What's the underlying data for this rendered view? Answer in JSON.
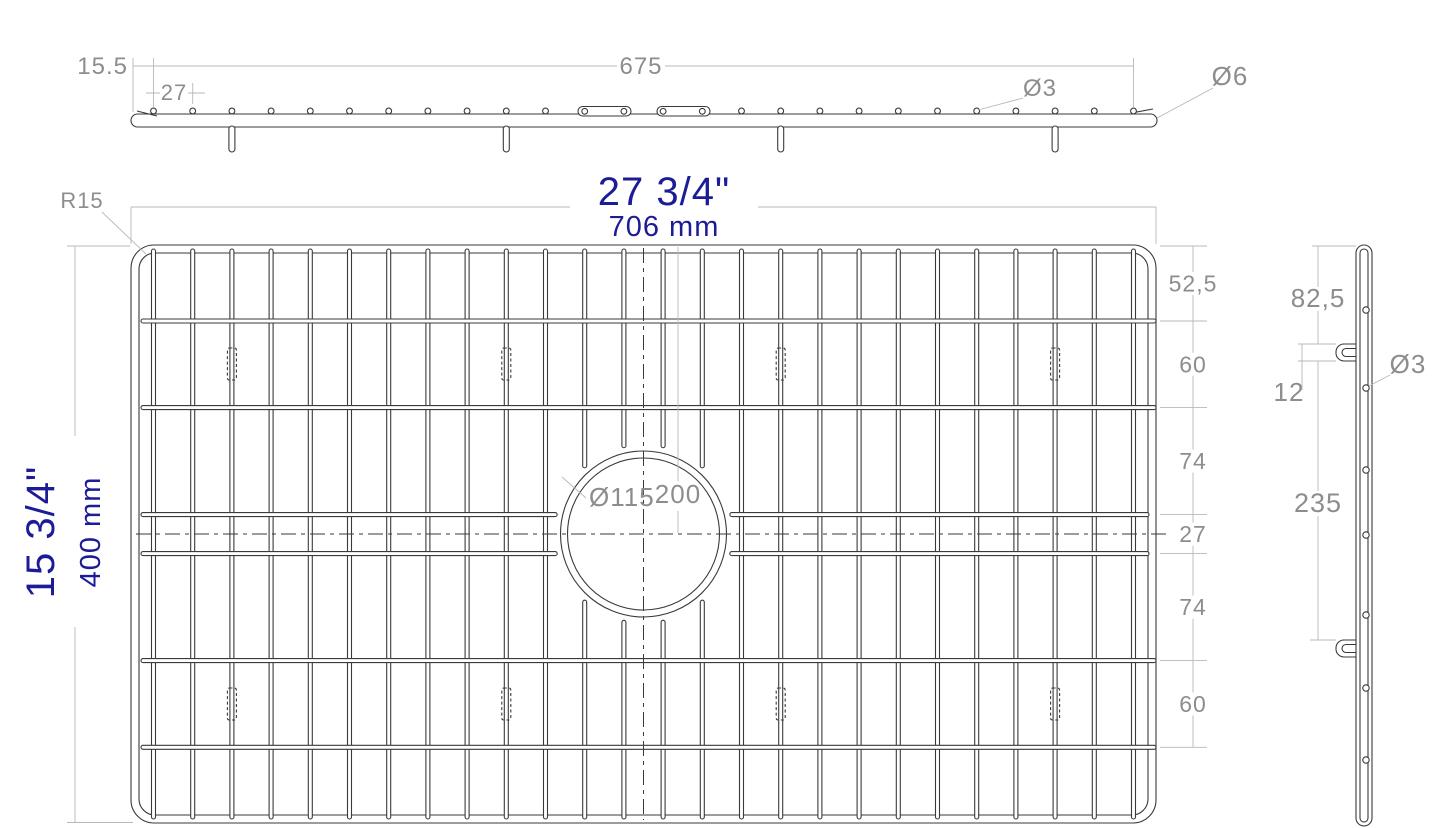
{
  "drawing_title": "sink grid technical drawing",
  "colors": {
    "object_line": "#3a3a3a",
    "dim_line": "#b8b8b8",
    "dim_text": "#8d8d8d",
    "accent_text": "#1c1c96",
    "background": "#ffffff"
  },
  "top_view": {
    "edge_offset": "15.5",
    "wire_pitch": "27",
    "span": "675",
    "wire_dia": "Ø3",
    "frame_dia": "Ø6"
  },
  "front_view": {
    "width_in": "27 3/4\"",
    "width_mm": "706 mm",
    "height_in": "15 3/4\"",
    "height_mm": "400 mm",
    "corner_radius": "R15",
    "center_hole_dia": "Ø115",
    "center_offset": "200",
    "right_chain": [
      "52,5",
      "60",
      "74",
      "27",
      "74",
      "60"
    ]
  },
  "side_view": {
    "top_offset": "82,5",
    "foot_length": "12",
    "feet_spacing": "235",
    "wire_dia": "Ø3"
  },
  "geometry": {
    "frame": {
      "x": 131,
      "y": 245,
      "w": 1025,
      "h": 578,
      "rx": 23
    },
    "wire_first_x": 153.5,
    "wire_pitch_px": 39.2,
    "wire_count": 26,
    "interrupted_wires": [
      11,
      12,
      13,
      14
    ],
    "rows_full": [
      321,
      407.6,
      660.6,
      747.3
    ],
    "rows_center": [
      514.6,
      553.6
    ],
    "circle": {
      "cx": 643.5,
      "cy": 534,
      "r_outer": 83,
      "r_inner": 76,
      "r_clear": 88.5
    },
    "feet_wire_indices": [
      2,
      9,
      16,
      23
    ],
    "feet_row_y": [
      348,
      688
    ],
    "chain_ext_ys": [
      246,
      321,
      407.6,
      514.6,
      553.6,
      660.6,
      747.3
    ],
    "chain_line_x": 1193,
    "top_bar": {
      "y": 114,
      "h": 13,
      "circle_y": 111,
      "circle_r": 2.9
    },
    "side_circle_ys": [
      310,
      388,
      470,
      535,
      615,
      688,
      760
    ],
    "side_circle_x": 1366
  }
}
